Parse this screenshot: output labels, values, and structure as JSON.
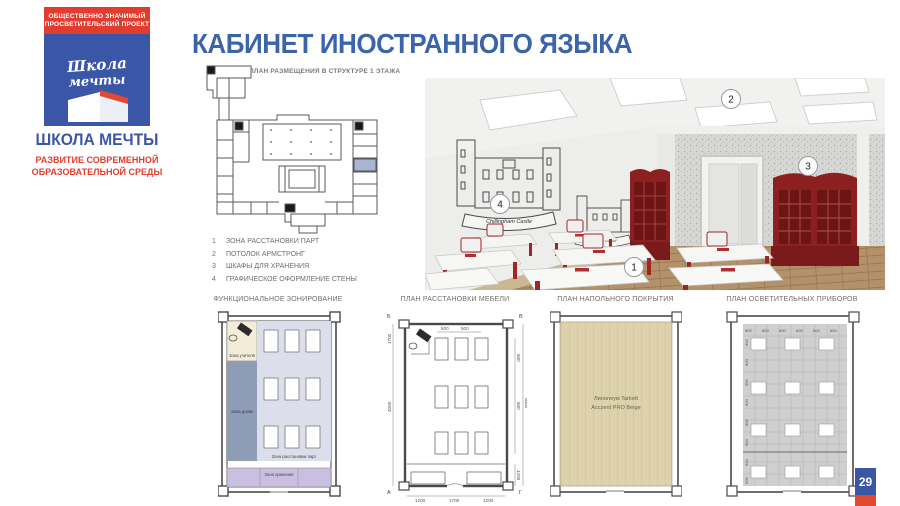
{
  "sidebar": {
    "badge_line1": "ОБЩЕСТВЕННО ЗНАЧИМЫЙ",
    "badge_line2": "ПРОСВЕТИТЕЛЬСКИЙ ПРОЕКТ",
    "logo_word1": "Школа",
    "logo_word2": "мечты",
    "brand": "ШКОЛА МЕЧТЫ",
    "tagline_line1": "РАЗВИТИЕ СОВРЕМЕННОЙ",
    "tagline_line2": "ОБРАЗОВАТЕЛЬНОЙ СРЕДЫ"
  },
  "header": {
    "title": "КАБИНЕТ ИНОСТРАННОГО ЯЗЫКА"
  },
  "site_plan": {
    "caption": "ПЛАН РАЗМЕЩЕНИЯ В СТРУКТУРЕ 1 ЭТАЖА"
  },
  "legend": {
    "items": [
      {
        "num": "1",
        "label": "ЗОНА РАССТАНОВКИ ПАРТ"
      },
      {
        "num": "2",
        "label": "ПОТОЛОК АРМСТРОНГ"
      },
      {
        "num": "3",
        "label": "ШКАФЫ ДЛЯ ХРАНЕНИЯ"
      },
      {
        "num": "4",
        "label": "ГРАФИЧЕСКОЕ ОФОРМЛЕНИЕ СТЕНЫ"
      }
    ]
  },
  "render": {
    "markers": {
      "m1": "1",
      "m2": "2",
      "m3": "3",
      "m4": "4"
    },
    "wall_art_caption1": "Chillingham Castle",
    "wall_art_caption2": "Conwy Castle"
  },
  "zoning_plan": {
    "title": "ФУНКЦИОНАЛЬНОЕ ЗОНИРОВАНИЕ",
    "zone_teacher": "Зона учителя",
    "zone_board": "Зона доски",
    "zone_desks": "Зона расстановки парт",
    "zone_storage": "Зона хранения"
  },
  "furniture_plan": {
    "title": "ПЛАН РАССТАНОВКИ МЕБЕЛИ",
    "dims": {
      "top1": "500",
      "top2": "500",
      "right1": "600",
      "right2": "600",
      "right_total": "6000",
      "right_bottom": "1200",
      "left_top": "1700",
      "left_mid": "4000",
      "bottom1": "1200",
      "bottom2": "1700",
      "bottom3": "1200"
    },
    "axes": {
      "tl": "Б",
      "tr": "В",
      "bl": "А",
      "br": "Г"
    }
  },
  "flooring_plan": {
    "title": "ПЛАН НАПОЛЬНОГО ПОКРЫТИЯ",
    "material_line1": "Линолеум Tarkett",
    "material_line2": "Acczent PRO Beige"
  },
  "lighting_plan": {
    "title": "ПЛАН ОСВЕТИТЕЛЬНЫХ ПРИБОРОВ",
    "dim": "600"
  },
  "page": {
    "number": "29"
  },
  "colors": {
    "brand_blue": "#3a57a7",
    "brand_red": "#e23c2e",
    "title_blue": "#3c64a8",
    "zone_teacher_fill": "#f2ecd9",
    "zone_board_fill": "#8e9cb5",
    "zone_desks_fill": "#dcdfeb",
    "zone_storage_fill": "#c9bfe0",
    "flooring_fill": "#ddd2ab",
    "cabinet_red": "#8c1f1f",
    "floor_wood": "#b3916a"
  }
}
